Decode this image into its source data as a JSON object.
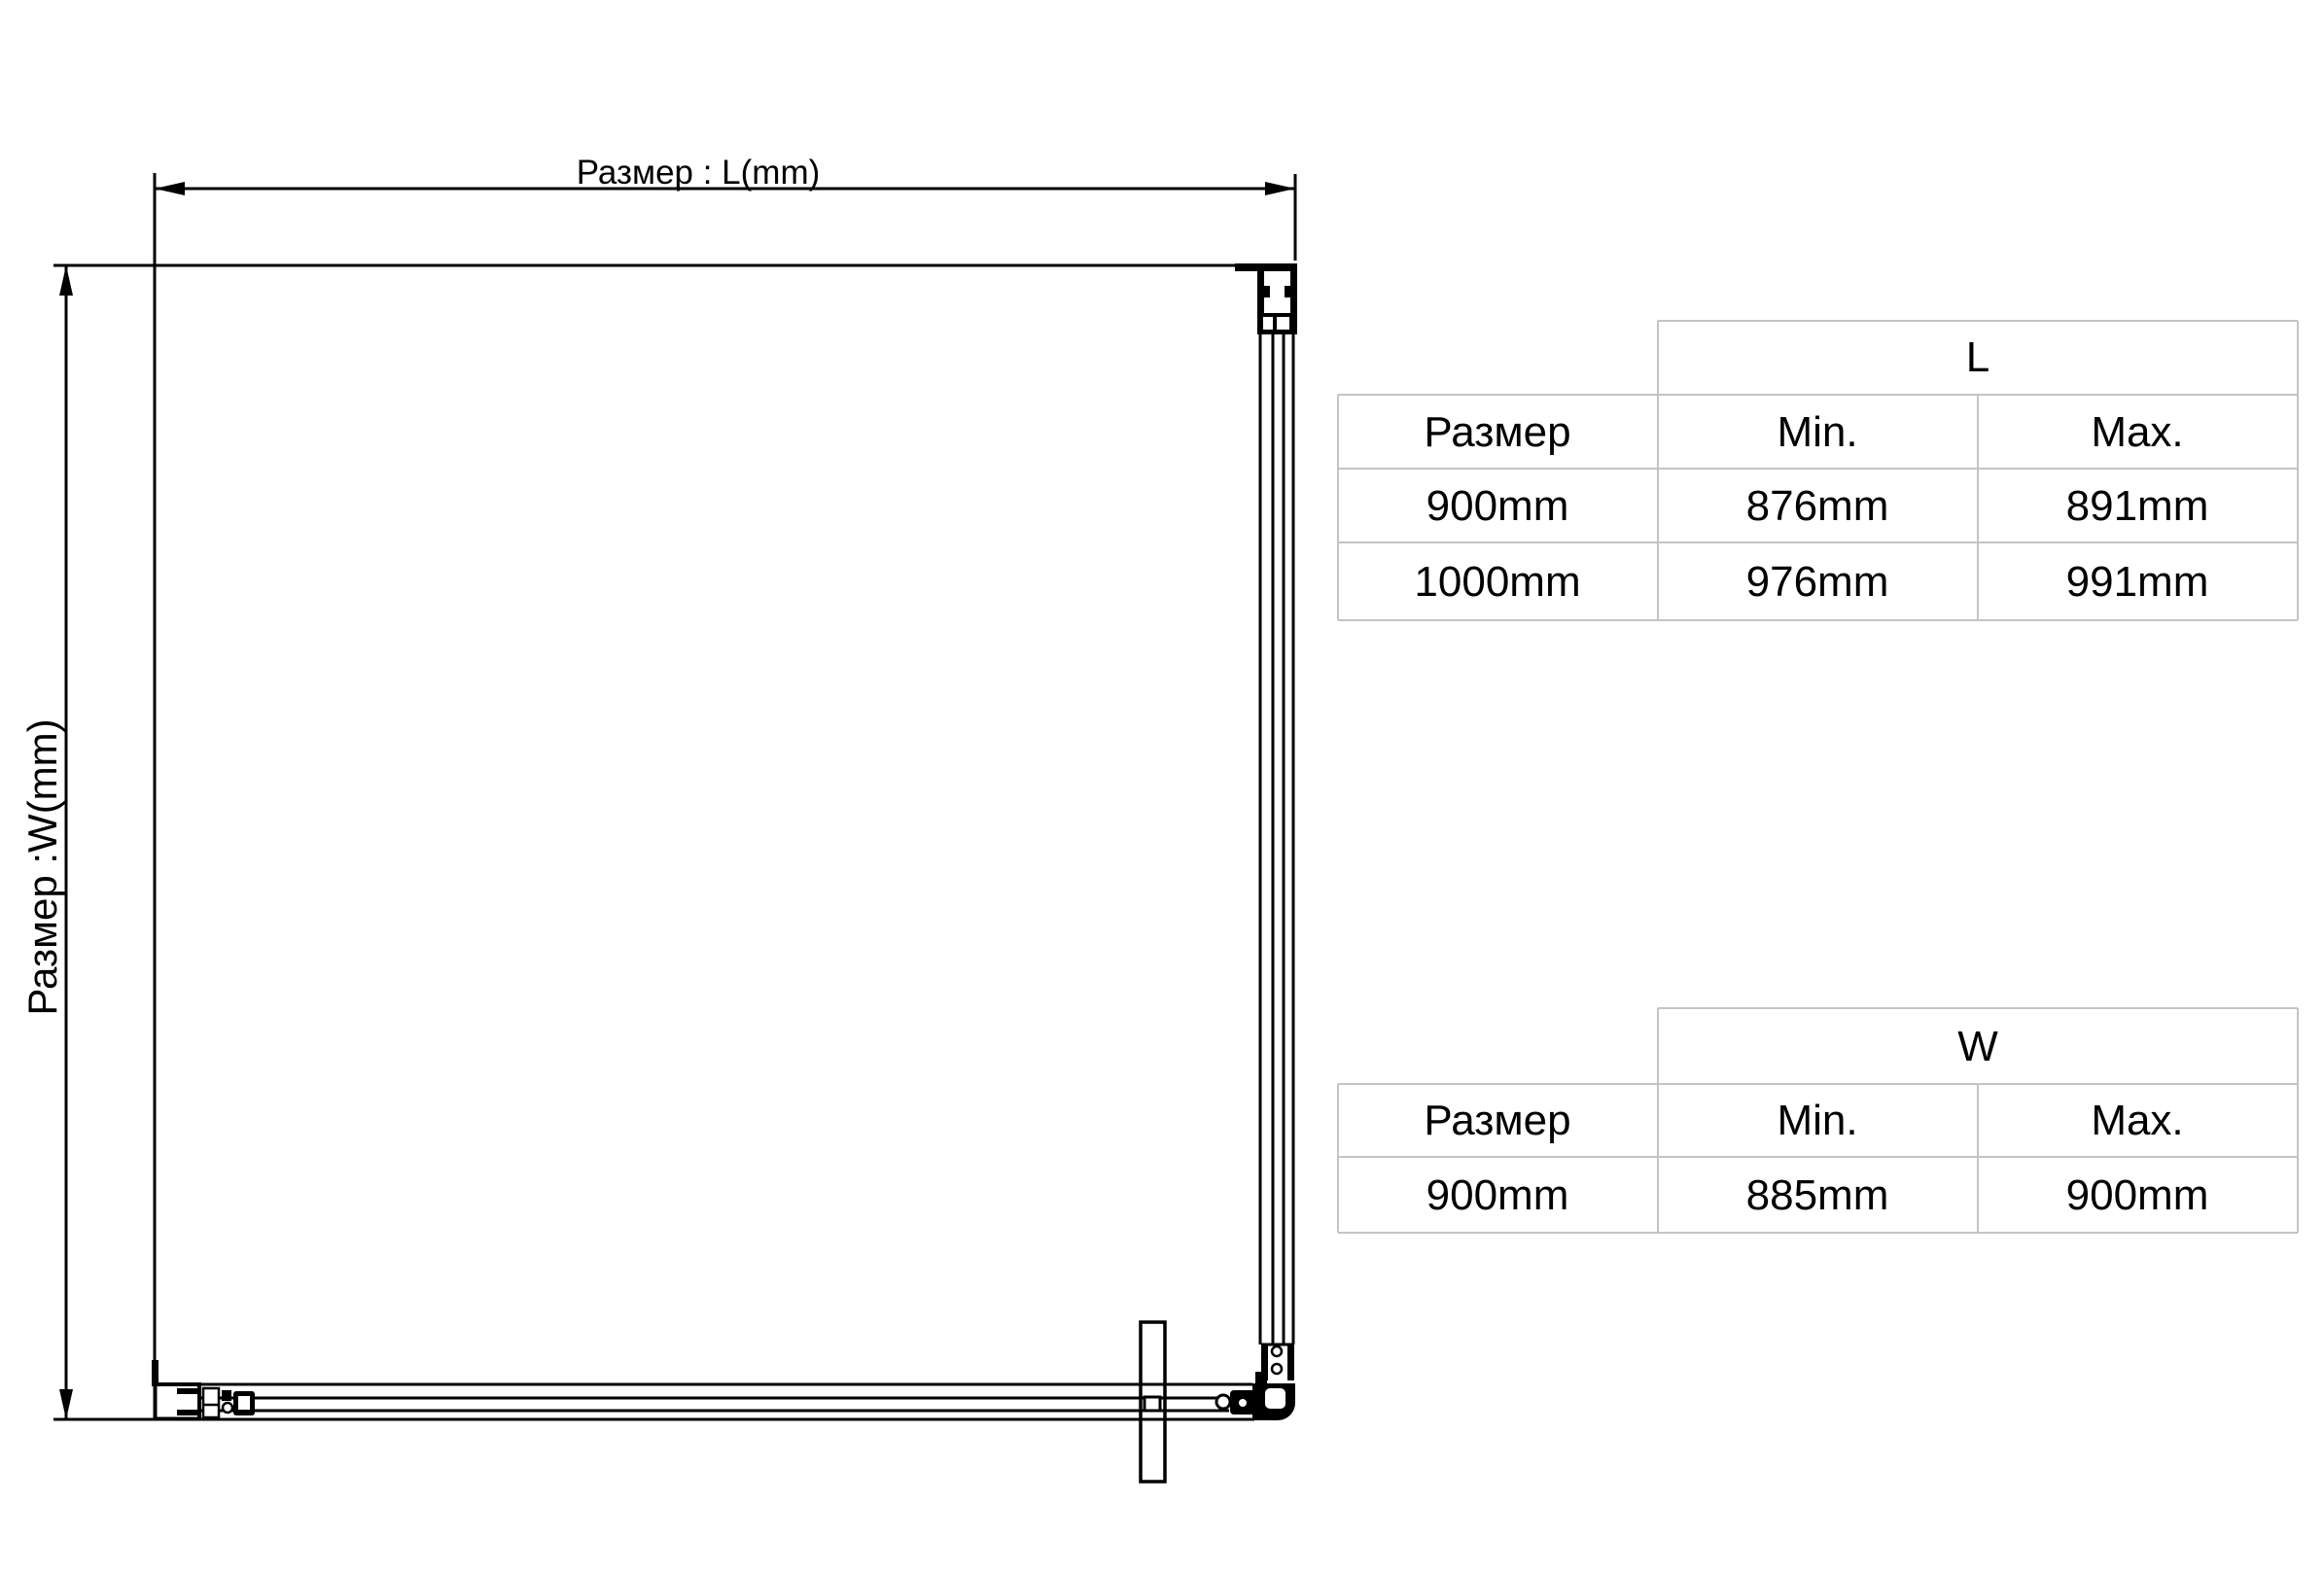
{
  "diagram": {
    "length_label": "Размер : L(mm)",
    "width_label": "Размер :W(mm)"
  },
  "tables": {
    "l": {
      "dimension": "L",
      "size_header": "Размер",
      "min_header": "Min.",
      "max_header": "Max.",
      "rows": [
        {
          "size": "900mm",
          "min": "876mm",
          "max": "891mm"
        },
        {
          "size": "1000mm",
          "min": "976mm",
          "max": "991mm"
        }
      ]
    },
    "w": {
      "dimension": "W",
      "size_header": "Размер",
      "min_header": "Min.",
      "max_header": "Max.",
      "rows": [
        {
          "size": "900mm",
          "min": "885mm",
          "max": "900mm"
        }
      ]
    }
  },
  "colors": {
    "drawing_line": "#000000",
    "table_grid": "#c4c4c4",
    "background": "#ffffff"
  }
}
